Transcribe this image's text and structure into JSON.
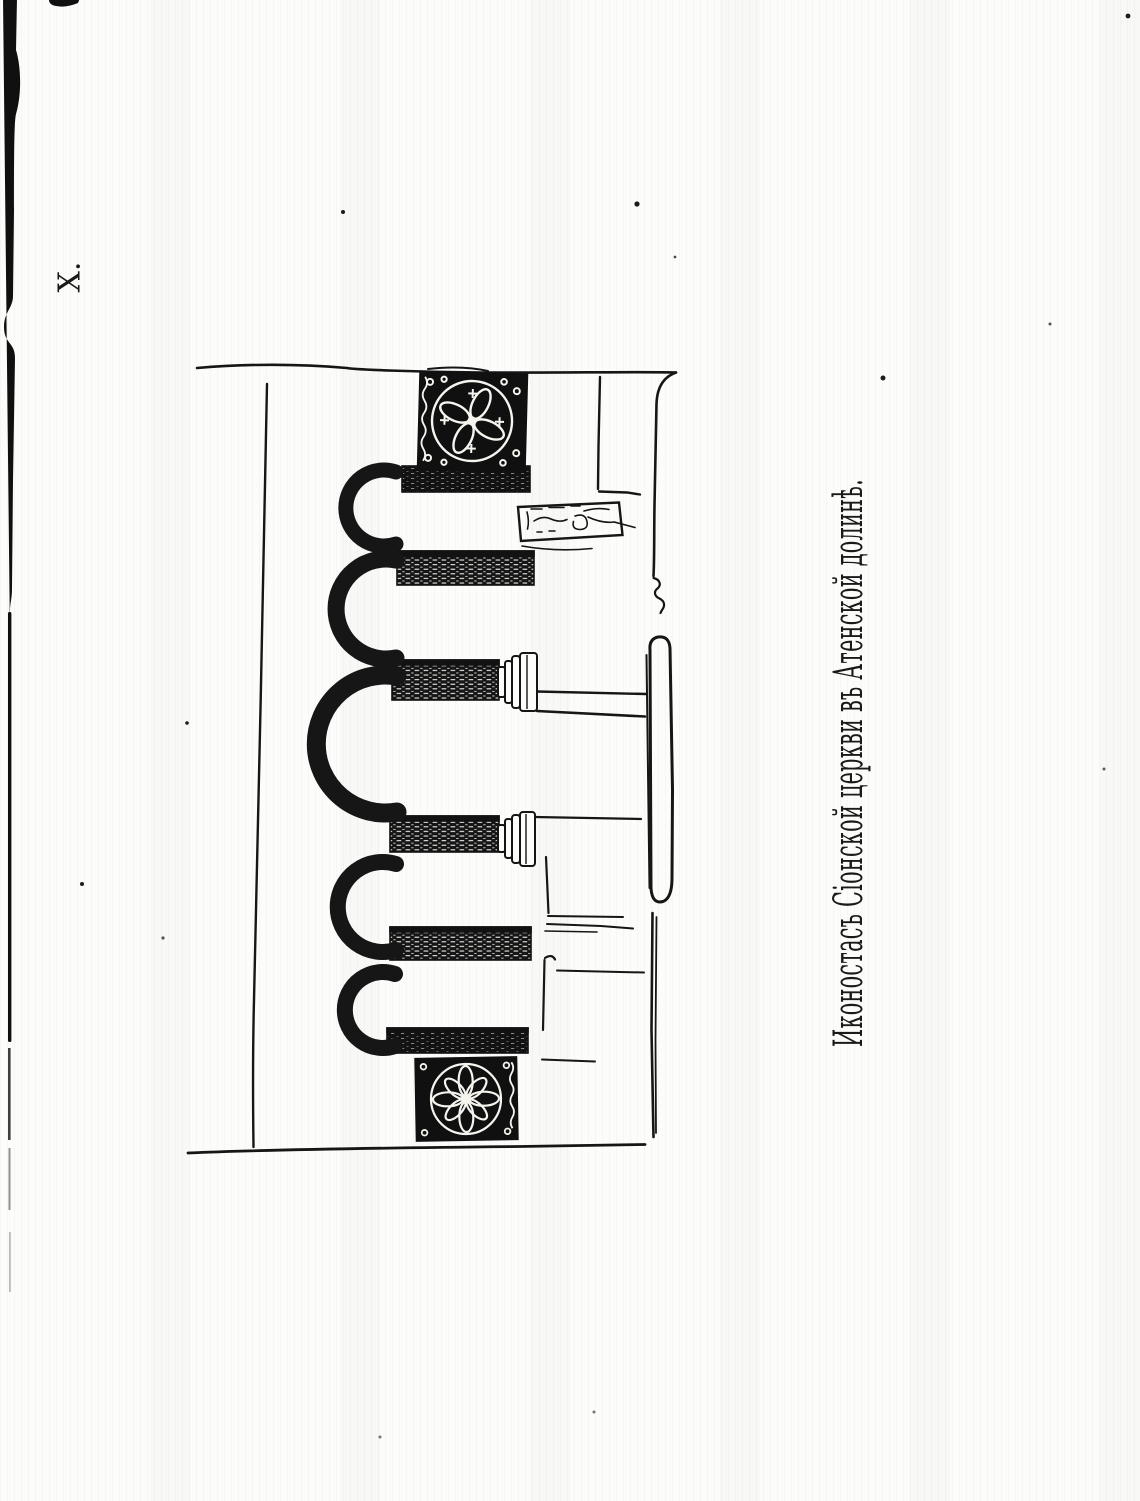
{
  "page": {
    "plate_label": "X.",
    "caption": "Иконостасъ Сіонской церкви въ Атенской долинѣ.",
    "colors": {
      "ink": "#161616",
      "paper": "#fcfcfa"
    }
  }
}
